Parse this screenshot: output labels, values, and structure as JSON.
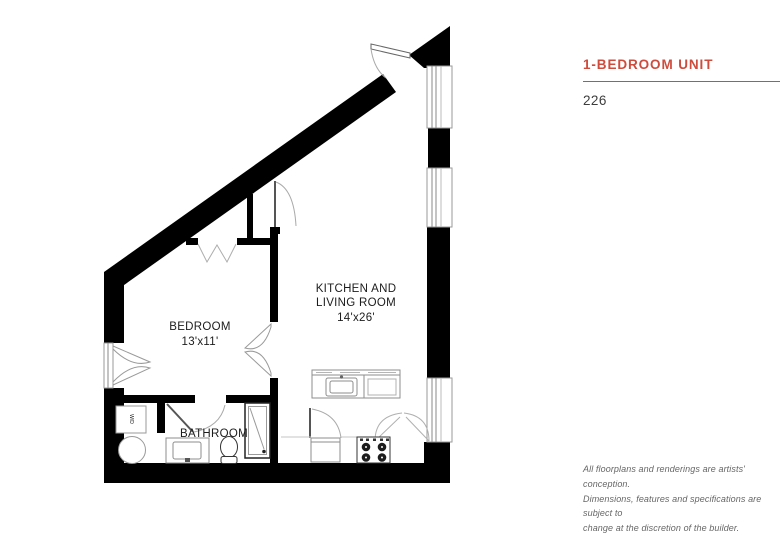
{
  "theme": {
    "accent_red": "#cf4b3c",
    "unit_number_text": "#3d3d3d",
    "disclaimer_gray": "#666666",
    "wall_black": "#000000",
    "fixture_gray": "#8e8e8e"
  },
  "info_panel": {
    "title": "1-BEDROOM UNIT",
    "unit_number": "226",
    "disclaimer_lines": [
      "All floorplans and renderings are artists' conception.",
      "Dimensions, features and specifications are subject to",
      "change at the discretion of the builder."
    ]
  },
  "floorplan": {
    "bedroom": {
      "name": "BEDROOM",
      "dims": "13'x11'"
    },
    "kitchen_living": {
      "name_line1": "KITCHEN AND",
      "name_line2": "LIVING ROOM",
      "dims": "14'x26'"
    },
    "bathroom": {
      "name": "BATHROOM"
    },
    "washer_dryer": {
      "label": "W/D"
    }
  }
}
